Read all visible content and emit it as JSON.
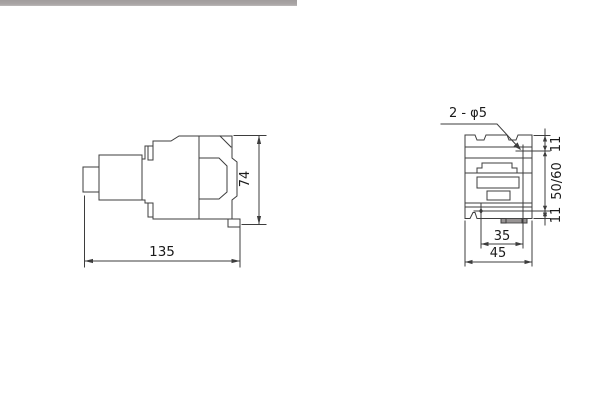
{
  "page": {
    "background": "#ffffff",
    "line_color": "#3d3d3d",
    "text_color": "#1a1a1a",
    "divider_color": "#a8a5a5"
  },
  "side_view": {
    "description": "contactor side profile view",
    "dims": {
      "width": "135",
      "height": "74"
    }
  },
  "front_view": {
    "description": "contactor rear mounting view",
    "hole_callout": "2 - φ5",
    "dims": {
      "top_offset": "11",
      "hole_vertical_spacing": "50/60",
      "bottom_offset": "11",
      "hole_horizontal_spacing": "35",
      "width": "45"
    }
  }
}
